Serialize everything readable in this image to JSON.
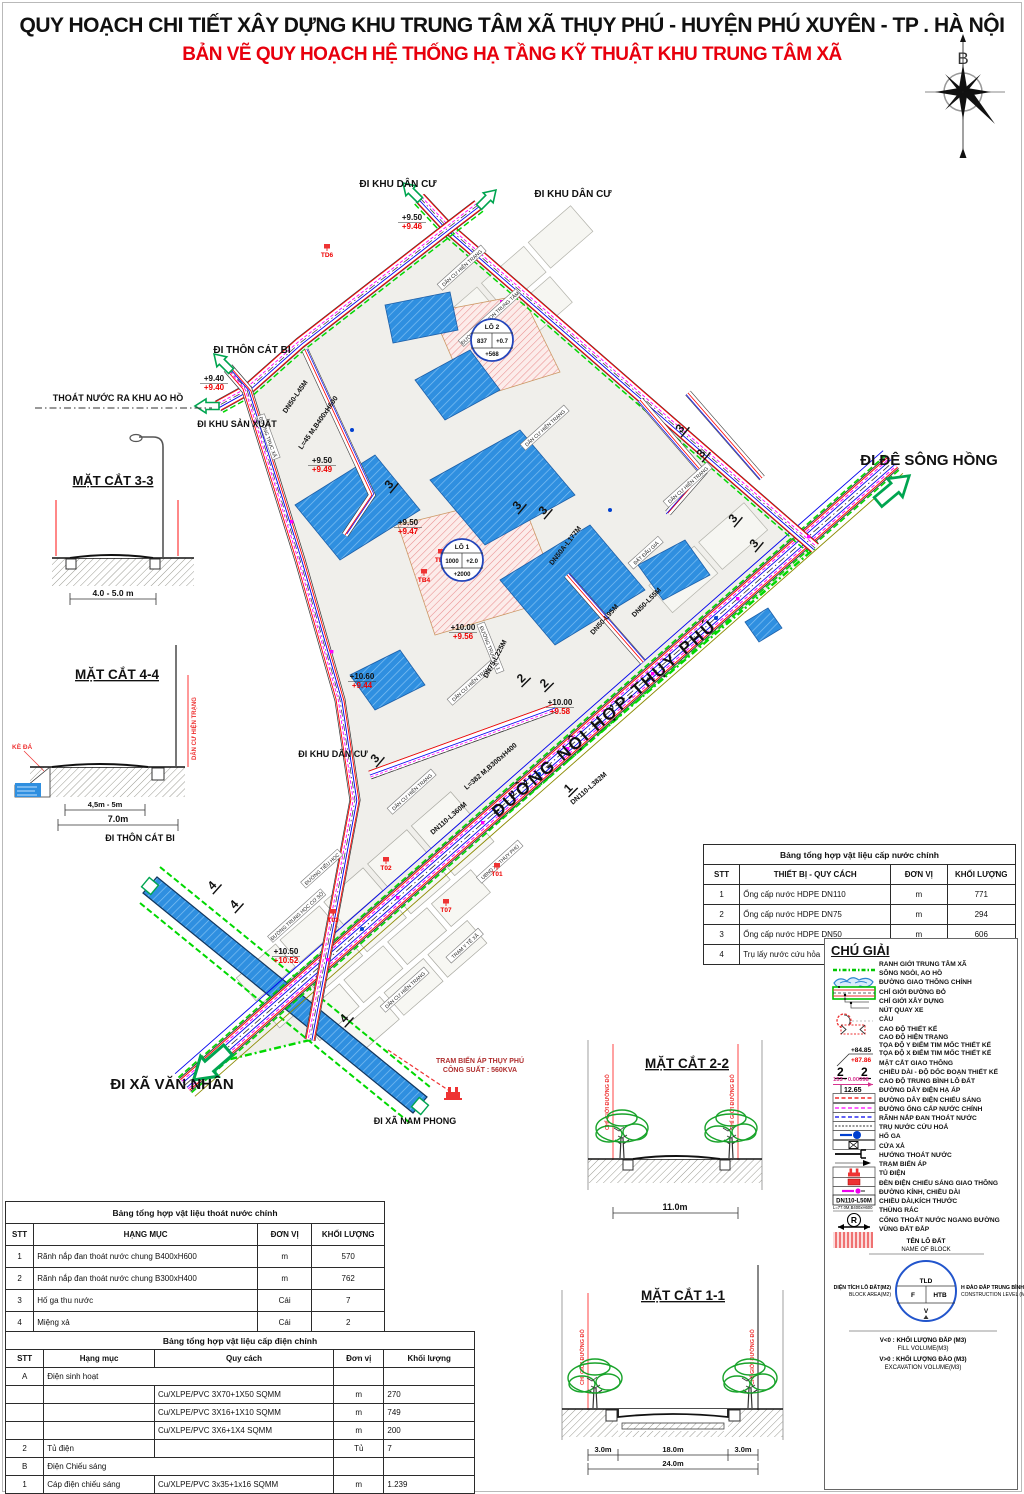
{
  "header": {
    "title": "QUY HOẠCH CHI TIẾT XÂY DỰNG KHU TRUNG TÂM XÃ THỤY PHÚ - HUYỆN PHÚ XUYÊN - TP . HÀ NỘI",
    "subtitle": "BẢN VẼ QUY HOẠCH HỆ THỐNG HẠ TẦNG KỸ THUẬT KHU TRUNG TÂM XÃ",
    "compass_north_label": "B"
  },
  "colors": {
    "title_red": "#e8000d",
    "boundary_green": "#00d800",
    "water_blue": "#2f8fe0",
    "line_red": "#ff0000",
    "line_magenta": "#ff00ff",
    "line_blue": "#0000ff"
  },
  "map": {
    "main_road_name": "ĐƯỜNG NỘI HỢP-THỤY PHÚ",
    "direction_labels": [
      [
        "ĐI KHU DÂN CƯ",
        398,
        187,
        10
      ],
      [
        "ĐI KHU DÂN CƯ",
        573,
        197,
        10
      ],
      [
        "ĐI THÔN CÁT BI",
        252,
        353,
        10
      ],
      [
        "THOÁT NƯỚC RA KHU AO HỒ",
        118,
        401,
        9
      ],
      [
        "ĐI KHU SẢN XUẤT",
        237,
        427,
        9
      ],
      [
        "ĐI ĐÊ SÔNG HỒNG",
        929,
        465,
        15
      ],
      [
        "ĐI KHU DÂN CƯ",
        333,
        757,
        9
      ],
      [
        "ĐI THÔN CÁT BI",
        140,
        841,
        9
      ],
      [
        "ĐI XÃ VĂN NHÂN",
        172,
        1089,
        15
      ],
      [
        "ĐI XÃ NAM PHONG",
        415,
        1124,
        9
      ]
    ],
    "elevation_pairs": [
      [
        "+9.50",
        "+9.46",
        412,
        220
      ],
      [
        "+9.40",
        "+9.40",
        214,
        381
      ],
      [
        "+9.50",
        "+9.49",
        322,
        463
      ],
      [
        "+9.50",
        "+9.47",
        408,
        525
      ],
      [
        "+10.00",
        "+9.56",
        463,
        630
      ],
      [
        "+10.60",
        "+9.44",
        362,
        679
      ],
      [
        "+10.00",
        "+9.58",
        560,
        705
      ],
      [
        "+10.50",
        "+10.52",
        286,
        954
      ]
    ],
    "pipe_labels": [
      [
        "DN50-L45M",
        297,
        398,
        -55
      ],
      [
        "L=45 M,B400xH600",
        320,
        424,
        -55
      ],
      [
        "DN50A-L177M",
        567,
        547,
        -52
      ],
      [
        "DN50-L95M",
        606,
        621,
        -48
      ],
      [
        "DN50-L55M",
        648,
        604,
        -45
      ],
      [
        "DN75-L225M",
        497,
        660,
        -62
      ],
      [
        "L=382 M,B300xH400",
        492,
        768,
        -41
      ],
      [
        "DN110-L382M",
        590,
        790,
        -41
      ],
      [
        "DN110-L360M",
        450,
        820,
        -41
      ]
    ],
    "road_boxes": [
      [
        "ĐƯỜNG TRỤC XÃ",
        268,
        437,
        70
      ],
      [
        "ĐƯỜNG TRỤC XÃ 1",
        490,
        648,
        68
      ],
      [
        "ĐƯỜNG TIỂU HỌC",
        322,
        869,
        -42
      ],
      [
        "ĐƯỜNG TRUNG HỌC CƠ SỞ",
        297,
        916,
        -42
      ],
      [
        "ĐƯỜNG MẦM NON TRUNG TÂM",
        490,
        318,
        -42
      ],
      [
        "ĐẤT ĐẤU GIÁ",
        646,
        553,
        -42
      ],
      [
        "TRẠM Y TẾ XÃ",
        465,
        946,
        -42
      ],
      [
        "UBND XÃ THỤY PHÚ",
        500,
        862,
        -42
      ],
      [
        "DÂN CƯ HIỆN TRẠNG",
        462,
        268,
        -42
      ],
      [
        "DÂN CƯ HIỆN TRẠNG",
        545,
        428,
        -42
      ],
      [
        "DÂN CƯ HIỆN TRẠNG",
        688,
        485,
        -42
      ],
      [
        "DÂN CƯ HIỆN TRẠNG",
        472,
        683,
        -42
      ],
      [
        "DÂN CƯ HIỆN TRẠNG",
        412,
        792,
        -42
      ],
      [
        "DÂN CƯ HIỆN TRẠNG",
        405,
        990,
        -42
      ]
    ],
    "section_markers": [
      [
        "3",
        392,
        487,
        -50
      ],
      [
        "3",
        520,
        508,
        -50
      ],
      [
        "3",
        546,
        513,
        -50
      ],
      [
        "3",
        683,
        431,
        -50
      ],
      [
        "3",
        704,
        456,
        -50
      ],
      [
        "3",
        736,
        521,
        -50
      ],
      [
        "3",
        757,
        546,
        -50
      ],
      [
        "2",
        524,
        681,
        -45
      ],
      [
        "2",
        547,
        686,
        -45
      ],
      [
        "3",
        378,
        761,
        -50
      ],
      [
        "1",
        571,
        791,
        -45
      ],
      [
        "4",
        215,
        888,
        -48
      ],
      [
        "4",
        237,
        907,
        -48
      ],
      [
        "4",
        347,
        1021,
        -48
      ]
    ],
    "stations": [
      [
        "TD6",
        327,
        257
      ],
      [
        "TB5",
        441,
        562
      ],
      [
        "TB4",
        424,
        582
      ],
      [
        "T02",
        386,
        870
      ],
      [
        "T01",
        497,
        876
      ],
      [
        "T03",
        333,
        922
      ],
      [
        "T07",
        446,
        912
      ]
    ],
    "lots": [
      {
        "name": "LÔ 1",
        "area": "1000",
        "level": "+2.0",
        "volume": "+2000",
        "x": 462,
        "y": 560
      },
      {
        "name": "LÔ 2",
        "area": "837",
        "level": "+0.7",
        "volume": "+568",
        "x": 492,
        "y": 340
      }
    ],
    "transformer_station": {
      "line1": "TRAM BIẾN ÁP THỤY PHÚ",
      "line2": "CÔNG SUẤT : 560KVA",
      "x": 480,
      "y": 1063
    }
  },
  "sections": {
    "s33": {
      "title": "MẶT CẮT 3-3",
      "dim": "4.0 - 5.0 m"
    },
    "s44": {
      "title": "MẶT CẮT 4-4",
      "dim_inner": "4,5m - 5m",
      "dim_outer": "7.0m",
      "ke_da": "KÈ ĐÁ",
      "right_label": "DÂN CƯ HIỆN TRẠNG"
    },
    "s22": {
      "title": "MẶT CẮT 2-2",
      "dim": "11.0m",
      "boundary_label": "CHỈ GIỚI ĐƯỜNG ĐỎ"
    },
    "s11": {
      "title": "MẶT CẮT 1-1",
      "dim_left": "3.0m",
      "dim_center": "18.0m",
      "dim_right": "3.0m",
      "dim_total": "24.0m",
      "boundary_label": "CHỈ GIỚI ĐƯỜNG ĐỎ"
    }
  },
  "tables": {
    "water": {
      "title": "Bảng tổng hợp vật liệu cấp nước chính",
      "headers": [
        "STT",
        "THIẾT BỊ - QUY CÁCH",
        "ĐƠN VỊ",
        "KHỐI LƯỢNG"
      ],
      "rows": [
        {
          "cells": [
            "1",
            "Ống cấp nước HDPE DN110",
            "m",
            "771"
          ]
        },
        {
          "cells": [
            "2",
            "Ống cấp nước HDPE DN75",
            "m",
            "294"
          ]
        },
        {
          "cells": [
            "3",
            "Ống cấp nước HDPE DN50",
            "m",
            "606"
          ]
        },
        {
          "cells": [
            "4",
            "Trụ lấy nước cứu hỏa",
            "Trụ",
            "7"
          ]
        }
      ]
    },
    "drainage": {
      "title": "Bảng tổng hợp vật liệu thoát nước chính",
      "headers": [
        "STT",
        "HẠNG MỤC",
        "ĐƠN VỊ",
        "KHỐI LƯỢNG"
      ],
      "rows": [
        {
          "cells": [
            "1",
            "Rãnh nắp đan thoát nước chung B400xH600",
            "m",
            "570"
          ]
        },
        {
          "cells": [
            "2",
            "Rãnh nắp đan thoát nước chung B300xH400",
            "m",
            "762"
          ]
        },
        {
          "cells": [
            "3",
            "Hố ga thu nước",
            "Cái",
            "7"
          ]
        },
        {
          "cells": [
            "4",
            "Miệng xả",
            "Cái",
            "2"
          ]
        },
        {
          "cells": [
            "5",
            "Thùng rác",
            "Cái",
            "23"
          ]
        }
      ]
    },
    "electric": {
      "title": "Bảng tổng hợp vật liệu cấp điện chính",
      "headers": [
        "STT",
        "Hạng mục",
        "Quy cách",
        "Đơn vị",
        "Khối lượng"
      ],
      "rows": [
        {
          "cells": [
            "A",
            "Điện sinh hoạt",
            "",
            ""
          ],
          "colspans": [
            1,
            2,
            1,
            1
          ]
        },
        {
          "cells": [
            "",
            "",
            "Cu/XLPE/PVC 3X70+1X50 SQMM",
            "m",
            "270"
          ]
        },
        {
          "cells": [
            "",
            "",
            "Cu/XLPE/PVC 3X16+1X10 SQMM",
            "m",
            "749"
          ]
        },
        {
          "cells": [
            "",
            "",
            "Cu/XLPE/PVC 3X6+1X4 SQMM",
            "m",
            "200"
          ]
        },
        {
          "cells": [
            "2",
            "Tủ điện",
            "",
            "Tủ",
            "7"
          ]
        },
        {
          "cells": [
            "B",
            "Điện Chiếu sáng",
            "",
            ""
          ],
          "colspans": [
            1,
            2,
            1,
            1
          ]
        },
        {
          "cells": [
            "1",
            "Cáp điện chiếu sáng",
            "Cu/XLPE/PVC 3x35+1x16 SQMM",
            "m",
            "1.239"
          ]
        },
        {
          "cells": [
            "2",
            "Tủ điện",
            "",
            "Tủ",
            "1"
          ]
        },
        {
          "cells": [
            "3",
            "Bóng đèn cao áp",
            "",
            "Bộ",
            "27"
          ]
        }
      ]
    }
  },
  "legend": {
    "title": "CHÚ GIẢI",
    "samples": {
      "design_level": "+84.85",
      "existing_level": "+87.86",
      "section_no": "2",
      "slope": "153 - 0.00098",
      "avg_level": "12.65",
      "dn": "DN110-L50M",
      "dim": "L=77.0M,B400xH600",
      "trash": "R"
    },
    "items": [
      {
        "sym": "boundary",
        "label": "RANH GIỚI TRUNG TÂM XÃ"
      },
      {
        "sym": "water",
        "label": "SÔNG NGÒI, AO HỒ"
      },
      {
        "sym": "mainroad",
        "label": "ĐƯỜNG GIAO THÔNG CHÍNH"
      },
      {
        "sym": "leader1",
        "label": "CHỈ GIỚI ĐƯỜNG ĐỎ"
      },
      {
        "sym": "leader2",
        "label": "CHỈ GIỚI XÂY DỰNG"
      },
      {
        "sym": "turnaround",
        "label": "NÚT QUAY XE"
      },
      {
        "sym": "bridge",
        "label": "CẦU"
      },
      {
        "sym": "elev",
        "labels": [
          "CAO ĐỘ THIẾT KẾ",
          "CAO ĐỘ HIỆN TRẠNG",
          "TỌA ĐỘ Y ĐIỂM TIM MỐC THIẾT KẾ",
          "TỌA ĐỘ X ĐIỂM TIM MỐC THIẾT KẾ"
        ]
      },
      {
        "sym": "secmark",
        "label": "MẶT CẮT GIAO THÔNG"
      },
      {
        "sym": "slope",
        "label": "CHIỀU DÀI - ĐỘ DỐC ĐOẠN THIẾT KẾ"
      },
      {
        "sym": "avglevel",
        "label": "CAO ĐỘ TRUNG BÌNH LÔ ĐẤT"
      },
      {
        "sym": "redline",
        "label": "ĐƯỜNG DÂY ĐIỆN HẠ ÁP"
      },
      {
        "sym": "magline",
        "label": "ĐƯỜNG DÂY ĐIỆN CHIẾU SÁNG"
      },
      {
        "sym": "blueline",
        "label": "ĐƯỜNG ỐNG CẤP NƯỚC CHÍNH"
      },
      {
        "sym": "drain",
        "label": "RÃNH NẮP ĐAN THOÁT NƯỚC"
      },
      {
        "sym": "hydrant",
        "label": "TRỤ NƯỚC CỨU HOẢ"
      },
      {
        "sym": "manhole",
        "label": "HỐ GA"
      },
      {
        "sym": "outlet",
        "label": "CỬA XẢ"
      },
      {
        "sym": "flow",
        "label": "HƯỚNG THOÁT NƯỚC"
      },
      {
        "sym": "transformer",
        "label": "TRẠM BIẾN ÁP"
      },
      {
        "sym": "cabinet",
        "label": "TỦ ĐIỆN"
      },
      {
        "sym": "light",
        "label": "ĐÈN ĐIỆN CHIẾU SÁNG GIAO THÔNG"
      },
      {
        "sym": "dnbox",
        "label": "ĐƯỜNG KÍNH, CHIỀU DÀI"
      },
      {
        "sym": "dims",
        "label": "CHIỀU DÀI,KÍCH THƯỚC"
      },
      {
        "sym": "trash",
        "label": "THÙNG RÁC"
      },
      {
        "sym": "culvert",
        "label": "CỐNG THOÁT NƯỚC NGANG ĐƯỜNG"
      },
      {
        "sym": "fillzone",
        "label": "VÙNG ĐẤT ĐẮP"
      }
    ],
    "block": {
      "ten": "TÊN LÔ ĐẤT",
      "name": "NAME OF BLOCK",
      "tld": "TLD",
      "f": "F",
      "htb": "HTB",
      "v": "V",
      "left1": "DIỆN TÍCH LÔ ĐẤT(M2)",
      "left2": "BLOCK AREA(M2)",
      "right1": "H ĐÀO ĐẮP TRUNG BÌNH(M)",
      "right2": "CONSTRUCTION LEVEL (M)",
      "fill1": "V<0 : KHỐI LƯỢNG ĐẮP (M3)",
      "fill2": "FILL VOLUME(M3)",
      "exc1": "V>0 : KHỐI LƯỢNG ĐÀO (M3)",
      "exc2": "EXCAVATION VOLUME(M3)"
    }
  }
}
